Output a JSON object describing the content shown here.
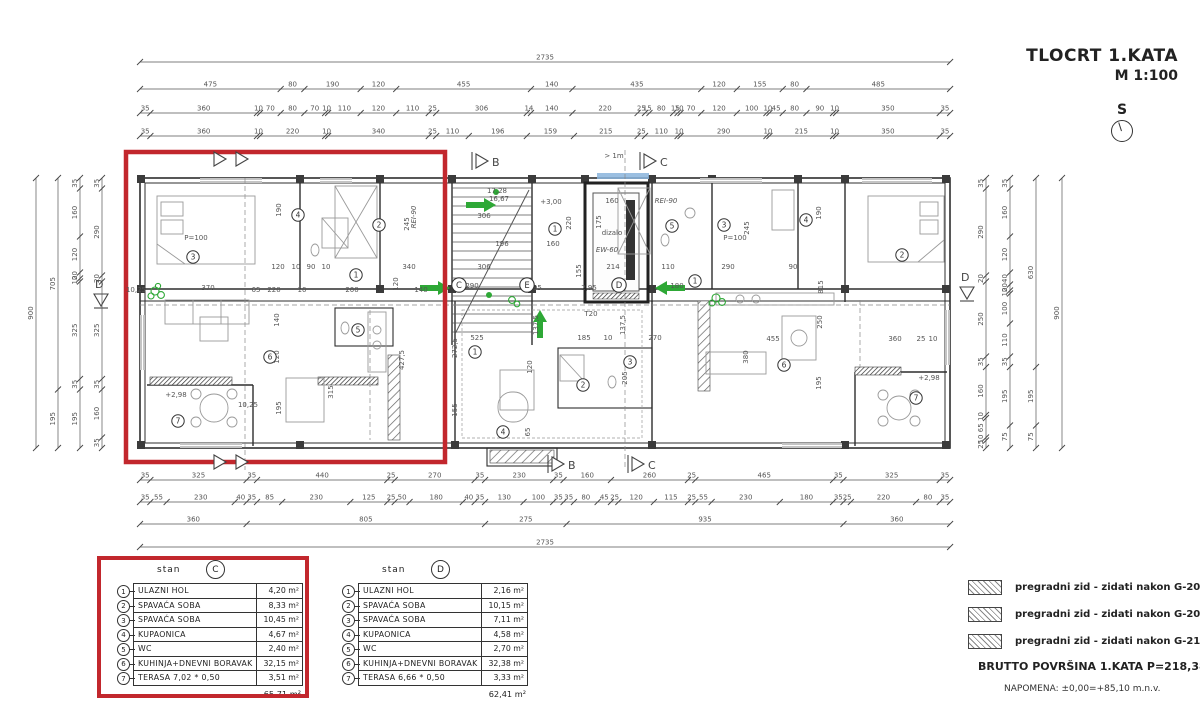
{
  "title_block": {
    "title": "TLOCRT 1.KATA",
    "scale": "M 1:100",
    "north": "S"
  },
  "dims": {
    "top": [
      [
        "2735"
      ],
      [
        "475",
        "80",
        "190",
        "120",
        "455",
        "140",
        "435",
        "120",
        "155",
        "80",
        "485"
      ],
      [
        "35",
        "360",
        "10",
        "70",
        "80",
        "70",
        "10",
        "110",
        "120",
        "110",
        "25",
        "306",
        "14",
        "140",
        "220",
        "25",
        "15",
        "80",
        "15",
        "10",
        "70",
        "120",
        "100",
        "10",
        "45",
        "80",
        "90",
        "10",
        "350",
        "35"
      ],
      [
        "35",
        "360",
        "10",
        "220",
        "10",
        "340",
        "25",
        "110",
        "196",
        "159",
        "215",
        "25",
        "110",
        "10",
        "290",
        "10",
        "215",
        "10",
        "350",
        "35"
      ]
    ],
    "bottom": [
      [
        "35",
        "325",
        "35",
        "440",
        "25",
        "270",
        "35",
        "230",
        "35",
        "160",
        "260",
        "25",
        "465",
        "35",
        "325",
        "35"
      ],
      [
        "35",
        "55",
        "230",
        "40",
        "35",
        "85",
        "230",
        "125",
        "25",
        "50",
        "180",
        "40",
        "35",
        "130",
        "100",
        "35",
        "35",
        "80",
        "45",
        "25",
        "120",
        "115",
        "25",
        "55",
        "230",
        "180",
        "35",
        "25",
        "220",
        "80",
        "35"
      ],
      [
        "360",
        "805",
        "275",
        "935",
        "360"
      ],
      [
        "2735"
      ]
    ],
    "left": [
      [
        "900"
      ],
      [
        "705",
        "195"
      ],
      [
        "35",
        "160",
        "120",
        "20",
        "10",
        "325",
        "35",
        "195"
      ],
      [
        "35",
        "290",
        "20",
        "325",
        "35",
        "160",
        "35"
      ]
    ],
    "right": [
      [
        "35",
        "290",
        "20",
        "250",
        "35",
        "160",
        "10",
        "65",
        "10",
        "25"
      ],
      [
        "35",
        "160",
        "120",
        "40",
        "20",
        "10",
        "100",
        "110",
        "35",
        "195",
        "75"
      ],
      [
        "630",
        "195",
        "75"
      ],
      [
        "900"
      ]
    ]
  },
  "plan": {
    "labels": [
      {
        "t": "190",
        "x": 281,
        "y": 210,
        "r": -90
      },
      {
        "t": "245",
        "x": 409,
        "y": 224,
        "r": -90
      },
      {
        "t": "120",
        "x": 278,
        "y": 269
      },
      {
        "t": "10",
        "x": 296,
        "y": 269
      },
      {
        "t": "90",
        "x": 311,
        "y": 269
      },
      {
        "t": "10",
        "x": 326,
        "y": 269
      },
      {
        "t": "340",
        "x": 409,
        "y": 269
      },
      {
        "t": "10,25",
        "x": 136,
        "y": 292
      },
      {
        "t": "370",
        "x": 208,
        "y": 290
      },
      {
        "t": "65",
        "x": 256,
        "y": 292
      },
      {
        "t": "220",
        "x": 274,
        "y": 292
      },
      {
        "t": "10",
        "x": 302,
        "y": 292
      },
      {
        "t": "200",
        "x": 352,
        "y": 292
      },
      {
        "t": "120",
        "x": 398,
        "y": 284,
        "r": -90
      },
      {
        "t": "140",
        "x": 421,
        "y": 292
      },
      {
        "t": "140",
        "x": 279,
        "y": 320,
        "r": -90
      },
      {
        "t": "120",
        "x": 279,
        "y": 357,
        "r": -90
      },
      {
        "t": "315",
        "x": 333,
        "y": 392,
        "r": -90
      },
      {
        "t": "195",
        "x": 281,
        "y": 408,
        "r": -90
      },
      {
        "t": "10,25",
        "x": 248,
        "y": 407
      },
      {
        "t": "+2,98",
        "x": 176,
        "y": 397
      },
      {
        "t": "427,5",
        "x": 404,
        "y": 360,
        "r": -90
      },
      {
        "t": "306",
        "x": 484,
        "y": 218
      },
      {
        "t": "196",
        "x": 502,
        "y": 246
      },
      {
        "t": "306",
        "x": 484,
        "y": 269
      },
      {
        "t": "290",
        "x": 472,
        "y": 288
      },
      {
        "t": "+3,00",
        "x": 551,
        "y": 204
      },
      {
        "t": "220",
        "x": 571,
        "y": 223,
        "r": -90
      },
      {
        "t": "160",
        "x": 553,
        "y": 246
      },
      {
        "t": "160",
        "x": 612,
        "y": 203
      },
      {
        "t": "175",
        "x": 601,
        "y": 222,
        "r": -90
      },
      {
        "t": "214",
        "x": 613,
        "y": 269
      },
      {
        "t": "155",
        "x": 581,
        "y": 271,
        "r": -90
      },
      {
        "t": "2,95",
        "x": 534,
        "y": 290
      },
      {
        "t": "2,95",
        "x": 589,
        "y": 290
      },
      {
        "t": "272,5",
        "x": 457,
        "y": 348,
        "r": -90
      },
      {
        "t": "137,5",
        "x": 538,
        "y": 325,
        "r": -90
      },
      {
        "t": "137,5",
        "x": 625,
        "y": 325,
        "r": -90
      },
      {
        "t": "T20",
        "x": 591,
        "y": 316
      },
      {
        "t": "185",
        "x": 584,
        "y": 340
      },
      {
        "t": "10",
        "x": 608,
        "y": 340
      },
      {
        "t": "270",
        "x": 655,
        "y": 340
      },
      {
        "t": "110",
        "x": 668,
        "y": 269
      },
      {
        "t": "290",
        "x": 728,
        "y": 269
      },
      {
        "t": "90",
        "x": 793,
        "y": 269
      },
      {
        "t": "190",
        "x": 821,
        "y": 213,
        "r": -90
      },
      {
        "t": "245",
        "x": 749,
        "y": 228,
        "r": -90
      },
      {
        "t": "180",
        "x": 677,
        "y": 288
      },
      {
        "t": "815",
        "x": 823,
        "y": 287,
        "r": -90
      },
      {
        "t": "250",
        "x": 822,
        "y": 322,
        "r": -90
      },
      {
        "t": "455",
        "x": 773,
        "y": 341
      },
      {
        "t": "360",
        "x": 895,
        "y": 341
      },
      {
        "t": "25",
        "x": 921,
        "y": 341
      },
      {
        "t": "10",
        "x": 933,
        "y": 341
      },
      {
        "t": "380",
        "x": 748,
        "y": 357,
        "r": -90
      },
      {
        "t": "195",
        "x": 821,
        "y": 383,
        "r": -90
      },
      {
        "t": "+2,98",
        "x": 929,
        "y": 380
      },
      {
        "t": "525",
        "x": 477,
        "y": 340
      },
      {
        "t": "120",
        "x": 532,
        "y": 367,
        "r": -90
      },
      {
        "t": "155",
        "x": 457,
        "y": 410,
        "r": -90
      },
      {
        "t": "65",
        "x": 530,
        "y": 432,
        "r": -90
      },
      {
        "t": "205",
        "x": 627,
        "y": 378,
        "r": -90
      },
      {
        "t": "REI-90",
        "x": 666,
        "y": 203,
        "it": 1,
        "fs": 6
      },
      {
        "t": "REI-90",
        "x": 416,
        "y": 217,
        "r": -90,
        "it": 1,
        "fs": 6
      },
      {
        "t": "dizalo",
        "x": 612,
        "y": 235,
        "fs": 8
      },
      {
        "t": "EW-60",
        "x": 607,
        "y": 252,
        "it": 1,
        "fs": 6.5
      },
      {
        "t": "> 1m",
        "x": 614,
        "y": 158,
        "fs": 8
      },
      {
        "t": "17,28",
        "x": 497,
        "y": 193,
        "fs": 5.5
      },
      {
        "t": "16,67",
        "x": 499,
        "y": 201,
        "fs": 5.5
      },
      {
        "t": "P=100",
        "x": 196,
        "y": 240,
        "fs": 5.5
      },
      {
        "t": "P=100",
        "x": 735,
        "y": 240,
        "fs": 5.5
      }
    ],
    "rooms": [
      {
        "n": "3",
        "x": 193,
        "y": 257
      },
      {
        "n": "4",
        "x": 298,
        "y": 215
      },
      {
        "n": "2",
        "x": 379,
        "y": 225
      },
      {
        "n": "1",
        "x": 356,
        "y": 275
      },
      {
        "n": "5",
        "x": 358,
        "y": 330
      },
      {
        "n": "6",
        "x": 270,
        "y": 357
      },
      {
        "n": "7",
        "x": 178,
        "y": 421
      },
      {
        "n": "1",
        "x": 555,
        "y": 229
      },
      {
        "n": "1",
        "x": 475,
        "y": 352
      },
      {
        "n": "2",
        "x": 583,
        "y": 385
      },
      {
        "n": "3",
        "x": 630,
        "y": 362
      },
      {
        "n": "4",
        "x": 503,
        "y": 432
      },
      {
        "n": "5",
        "x": 672,
        "y": 226
      },
      {
        "n": "3",
        "x": 724,
        "y": 225
      },
      {
        "n": "4",
        "x": 806,
        "y": 220
      },
      {
        "n": "2",
        "x": 902,
        "y": 255
      },
      {
        "n": "1",
        "x": 695,
        "y": 281
      },
      {
        "n": "6",
        "x": 784,
        "y": 365
      },
      {
        "n": "7",
        "x": 916,
        "y": 398
      }
    ],
    "letters": [
      {
        "t": "C",
        "x": 459,
        "y": 285
      },
      {
        "t": "E",
        "x": 527,
        "y": 285
      },
      {
        "t": "D",
        "x": 619,
        "y": 285
      }
    ],
    "section_markers": {
      "b": "B",
      "c": "C",
      "d": "D"
    }
  },
  "tables": [
    {
      "unit_label": "stan",
      "unit": "C",
      "rows": [
        {
          "n": "1",
          "name": "ULAZNI HOL",
          "area": "4,20"
        },
        {
          "n": "2",
          "name": "SPAVAĆA SOBA",
          "area": "8,33"
        },
        {
          "n": "3",
          "name": "SPAVAĆA SOBA",
          "area": "10,45"
        },
        {
          "n": "4",
          "name": "KUPAONICA",
          "area": "4,67"
        },
        {
          "n": "5",
          "name": "WC",
          "area": "2,40"
        },
        {
          "n": "6",
          "name": "KUHINJA+DNEVNI BORAVAK",
          "area": "32,15"
        },
        {
          "n": "7",
          "name": "TERASA 7,02 * 0,50",
          "area": "3,51"
        }
      ],
      "total": "65,71",
      "unit_suffix": "m²"
    },
    {
      "unit_label": "stan",
      "unit": "D",
      "rows": [
        {
          "n": "1",
          "name": "ULAZNI HOL",
          "area": "2,16"
        },
        {
          "n": "2",
          "name": "SPAVAĆA SOBA",
          "area": "10,15"
        },
        {
          "n": "3",
          "name": "SPAVAĆA SOBA",
          "area": "7,11"
        },
        {
          "n": "4",
          "name": "KUPAONICA",
          "area": "4,58"
        },
        {
          "n": "5",
          "name": "WC",
          "area": "2,70"
        },
        {
          "n": "6",
          "name": "KUHINJA+DNEVNI BORAVAK",
          "area": "32,38"
        },
        {
          "n": "7",
          "name": "TERASA 6,66 * 0,50",
          "area": "3,33"
        }
      ],
      "total": "62,41",
      "unit_suffix": "m²"
    }
  ],
  "legend": {
    "items": [
      "pregradni zid - zidati nakon G-202",
      "pregradni zid - zidati nakon G-209",
      "pregradni zid - zidati nakon G-210"
    ]
  },
  "notes": {
    "brutto": "BRUTTO POVRŠINA 1.KATA  P=218,38 m²",
    "napomena": "NAPOMENA: ±0,00=+85,10 m.n.v."
  },
  "colors": {
    "red": "#c2272d",
    "green": "#2ea836",
    "blue": "#8ab4dc"
  }
}
